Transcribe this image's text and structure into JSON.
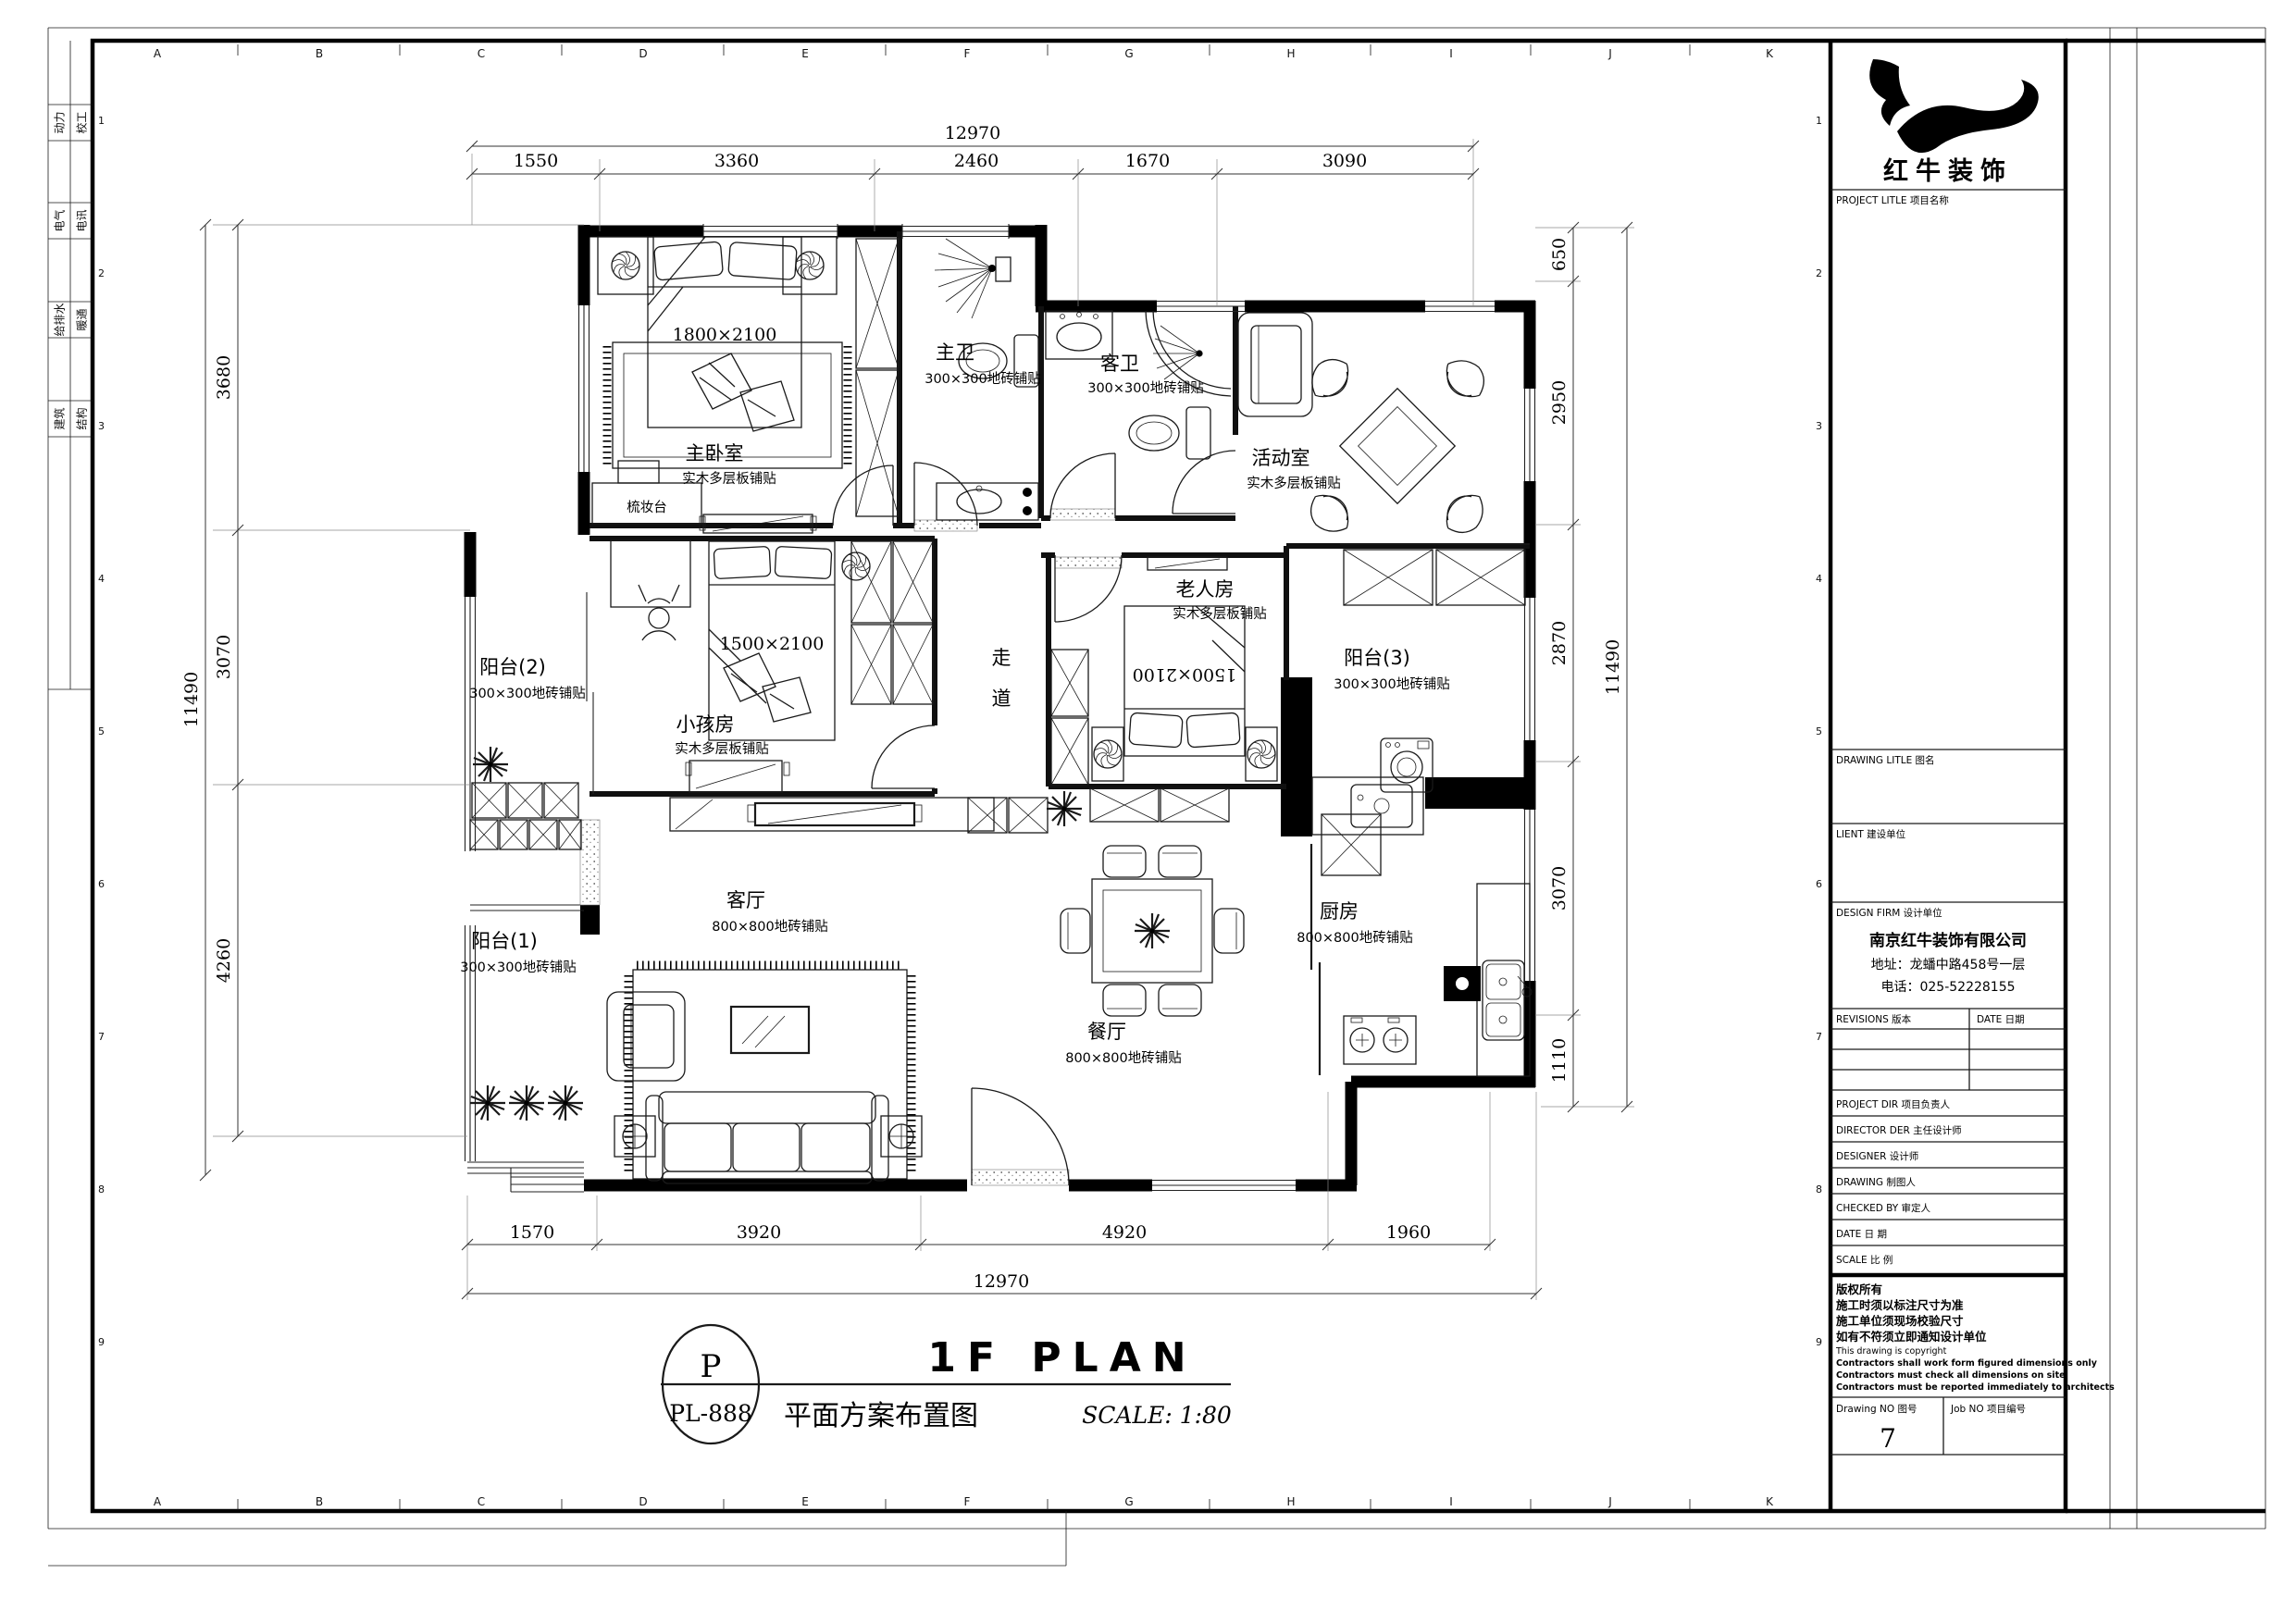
{
  "sheet": {
    "grid_letters": [
      "A",
      "B",
      "C",
      "D",
      "E",
      "F",
      "G",
      "H",
      "I",
      "J",
      "K"
    ],
    "row_numbers": [
      "1",
      "2",
      "3",
      "4",
      "5",
      "6",
      "7",
      "8",
      "9"
    ],
    "disciplines": [
      "动力",
      "校工",
      "电气",
      "电讯",
      "给排水",
      "暖通",
      "建筑",
      "结构"
    ]
  },
  "title_block": {
    "logo_name": "红牛装饰",
    "project_label": "PROJECT LITLE  项目名称",
    "drawing_label": "DRAWING LITLE  图名",
    "client_label": "LIENT  建设单位",
    "design_firm_label": "DESIGN FIRM  设计单位",
    "company_name": "南京红牛装饰有限公司",
    "company_address": "地址：龙蟠中路458号一层",
    "company_phone": "电话：025-52228155",
    "revisions_label": "REVISIONS  版本",
    "date_col_label": "DATE  日期",
    "sign_rows": [
      "PROJECT DIR    项目负责人",
      "DIRECTOR DER 主任设计师",
      "DESIGNER        设计师",
      "DRAWING         制图人",
      "CHECKED BY    审定人",
      "DATE                日  期",
      "SCALE              比  例"
    ],
    "copyright": [
      "版权所有",
      "施工时须以标注尺寸为准",
      "施工单位须现场校验尺寸",
      "如有不符须立即通知设计单位",
      "This drawing is copyright",
      "Contractors shall work form figured dimensions only",
      "Contractors must check all dimensions on site",
      "Contractors must be reported immediately to architects"
    ],
    "drawing_no_label": "Drawing NO  图号",
    "drawing_no_value": "7",
    "job_no_label": "Job NO  项目编号"
  },
  "plan": {
    "rooms": [
      {
        "name": "主卧室",
        "finish": "实木多层板铺贴"
      },
      {
        "name": "主卫",
        "finish": "300×300地砖铺贴"
      },
      {
        "name": "客卫",
        "finish": "300×300地砖铺贴"
      },
      {
        "name": "活动室",
        "finish": "实木多层板铺贴"
      },
      {
        "name": "小孩房",
        "finish": "实木多层板铺贴"
      },
      {
        "name": "老人房",
        "finish": "实木多层板铺贴"
      },
      {
        "name": "客厅",
        "finish": "800×800地砖铺贴"
      },
      {
        "name": "餐厅",
        "finish": "800×800地砖铺贴"
      },
      {
        "name": "厨房",
        "finish": "800×800地砖铺贴"
      },
      {
        "name": "阳台(1)",
        "finish": "300×300地砖铺贴"
      },
      {
        "name": "阳台(2)",
        "finish": "300×300地砖铺贴"
      },
      {
        "name": "阳台(3)",
        "finish": "300×300地砖铺贴"
      }
    ],
    "corridor": [
      "走",
      "道"
    ],
    "labels": {
      "dresser": "梳妆台",
      "bed_master": "1800×2100",
      "bed_kids": "1500×2100",
      "bed_elder": "1500×2100"
    },
    "dims": {
      "top_total": "12970",
      "top": [
        "1550",
        "3360",
        "2460",
        "1670",
        "3090"
      ],
      "bottom": [
        "1570",
        "3920",
        "4920",
        "1960"
      ],
      "bottom_total": "12970",
      "left": [
        "3680",
        "3070",
        "4260"
      ],
      "left_total": "11490",
      "right": [
        "650",
        "2950",
        "2870",
        "3070",
        "1110"
      ],
      "right_total": "11490"
    }
  },
  "footer": {
    "stamp_letter": "P",
    "stamp_code": "PL-888",
    "title": "1F PLAN",
    "subtitle": "平面方案布置图",
    "scale": "SCALE: 1:80"
  }
}
